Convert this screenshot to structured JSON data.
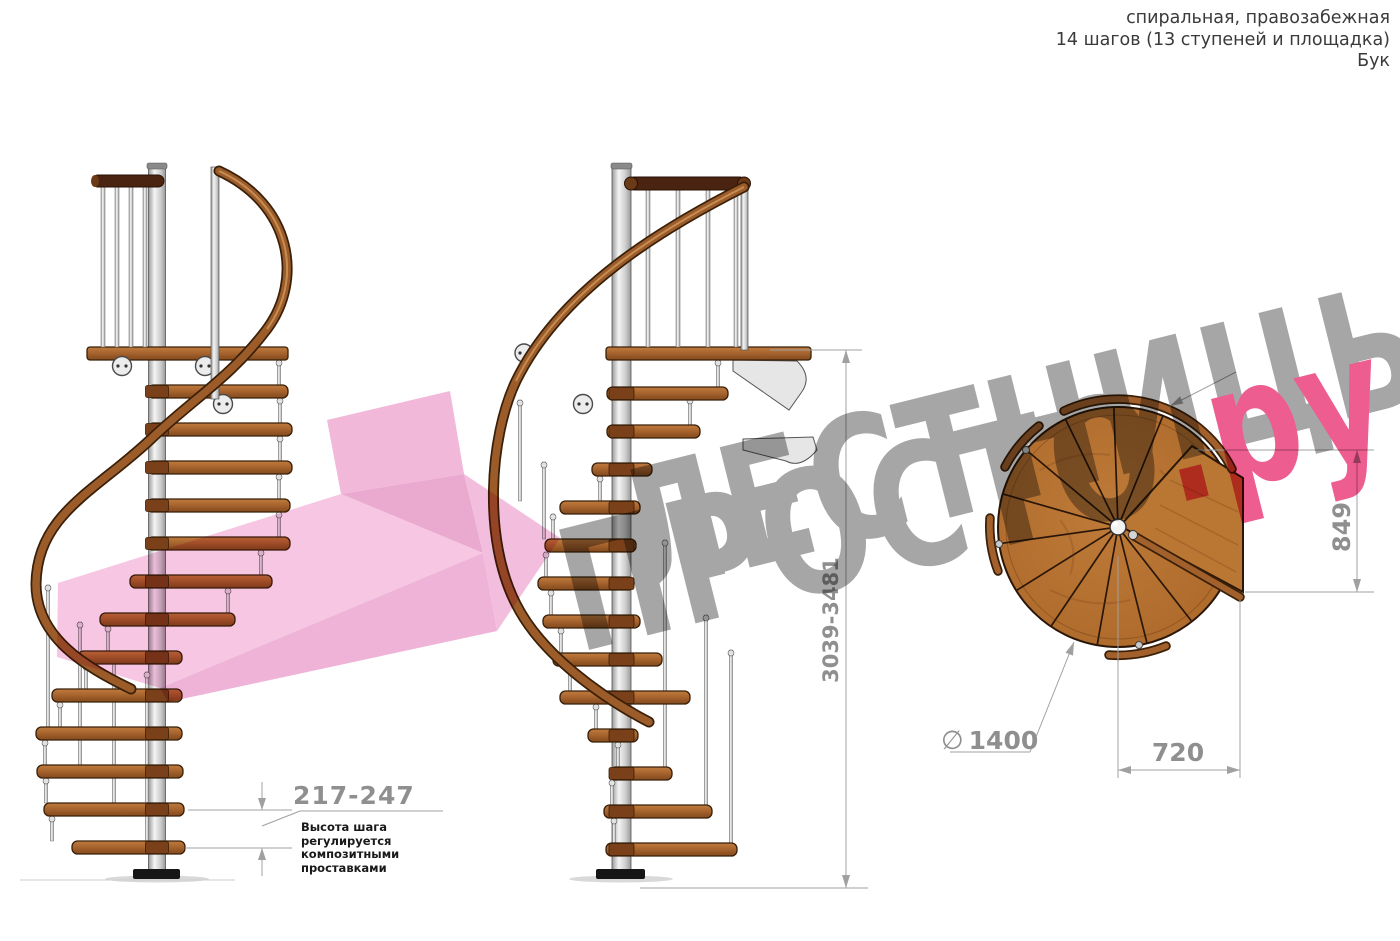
{
  "header": {
    "lines": [
      "спиральная, правозабежная",
      "14 шагов (13 ступеней и площадка)",
      "Бук"
    ]
  },
  "watermark": {
    "word1": "ЛЕСТНИЦЫ",
    "word2": "ПРОСТО",
    "word2_suffix": ".ру",
    "text_color": "#a6a6a6",
    "suffix_color": "#ee5d8f"
  },
  "dimensions": {
    "total_height": "3039-3481",
    "step_height": "217-247",
    "step_height_note_lines": [
      "Высота шага",
      "регулируется",
      "композитными",
      "проставками"
    ],
    "landing_depth": "849",
    "landing_width": "720",
    "diameter_symbol": "∅",
    "diameter_value": "1400"
  },
  "colors": {
    "wood": "#b4702f",
    "wood_dark": "#8a5222",
    "handrail": "#9c5c2a",
    "metal_light": "#f2f2f2",
    "dim_gray": "#a0a0a0",
    "watermark_pink": "#f3bcdc"
  }
}
